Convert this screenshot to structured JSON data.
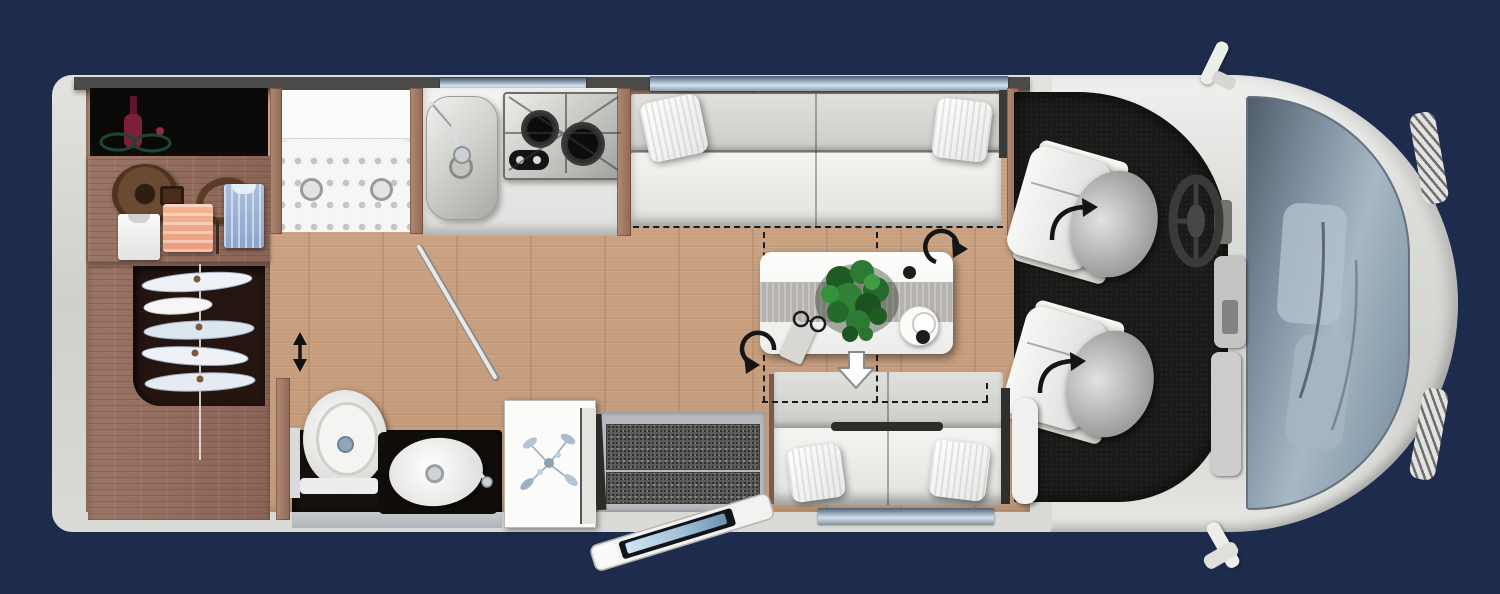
{
  "meta": {
    "title": "Motorhome floor plan — top view",
    "canvas_width": 1500,
    "canvas_height": 594
  },
  "palette": {
    "background": "#1d2b4c",
    "vehicle_body": "#dcddd9",
    "wall_dark": "#4a4a48",
    "floor_wood": "#c79d7c",
    "wardrobe_wood": "#94705f",
    "cab_floor": "#1a1a18",
    "upholstery": "#efefed",
    "window_glass": "#8ea3b6",
    "windshield_glass": "#8496a6",
    "plant_green": "#2c7a33",
    "steel": "#b9bab6",
    "burner_black": "#141414",
    "dashed_line": "#1b1b1b",
    "step_tread": "#5f5f5d"
  },
  "areas": {
    "vehicle": "Motorhome floor plan (top view)",
    "rear_storage": "Rear storage compartment",
    "rear_shelf": "Shelf with clothing",
    "wardrobe": "Wardrobe with hanging rail",
    "shower": "Shower cubicle",
    "bathroom": "Washroom",
    "toilet": "Toilet",
    "washbasin": "Washbasin",
    "kitchen": "Kitchen block",
    "sink": "Kitchen sink",
    "stove": "Two-burner hob",
    "lounge_sofa": "Lounge sofa",
    "dinette_table": "Movable dinette table",
    "bench": "Seating bench / bed conversion",
    "entry_steps": "Entrance steps",
    "entry_door": "Entrance door (open)",
    "cabinet": "Cabinet with decor print",
    "cab": "Driver cab",
    "driver_seat": "Swivelling driver seat",
    "passenger_seat": "Swivelling passenger seat",
    "steering_wheel": "Steering wheel",
    "windshield": "Windscreen",
    "window": "Window",
    "mirror": "Exterior mirror",
    "plant": "Table plant"
  },
  "indicators": {
    "rotate": "Rotation indicator",
    "slide_down": "Table slide indicator",
    "sliding_door": "Sliding door indicator",
    "bed_outline": "Bed conversion outline"
  }
}
